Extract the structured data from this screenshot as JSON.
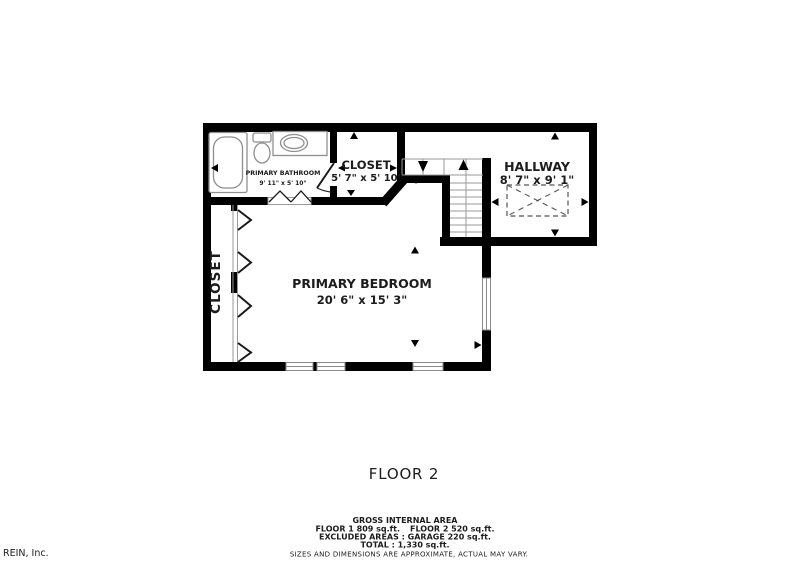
{
  "colors": {
    "wall": "#000000",
    "thin_line": "#9a9a9a",
    "text": "#1c1c1c",
    "muted_text": "#9a9a9a",
    "watermark": "#b6bac0"
  },
  "rooms": {
    "primary_bathroom": {
      "name": "PRIMARY BATHROOM",
      "dims": "9' 11\" x 5' 10\""
    },
    "closet_upper": {
      "name": "CLOSET",
      "dims": "5' 7\" x 5' 10\""
    },
    "hallway": {
      "name": "HALLWAY",
      "dims": "8' 7\" x 9' 1\""
    },
    "primary_bedroom": {
      "name": "PRIMARY BEDROOM",
      "dims": "20' 6\" x 15' 3\""
    },
    "closet_left": {
      "name": "CLOSET"
    }
  },
  "floor_label": "FLOOR 2",
  "footer": {
    "title": "GROSS INTERNAL AREA",
    "floor1": "FLOOR 1 809 sq.ft.",
    "floor2": "FLOOR 2 520 sq.ft.",
    "excluded": "EXCLUDED AREAS :  GARAGE 220 sq.ft.",
    "total": "TOTAL :  1,330 sq.ft.",
    "disclaimer": "SIZES AND DIMENSIONS ARE APPROXIMATE, ACTUAL MAY VARY."
  },
  "watermark": "REIN, Inc."
}
